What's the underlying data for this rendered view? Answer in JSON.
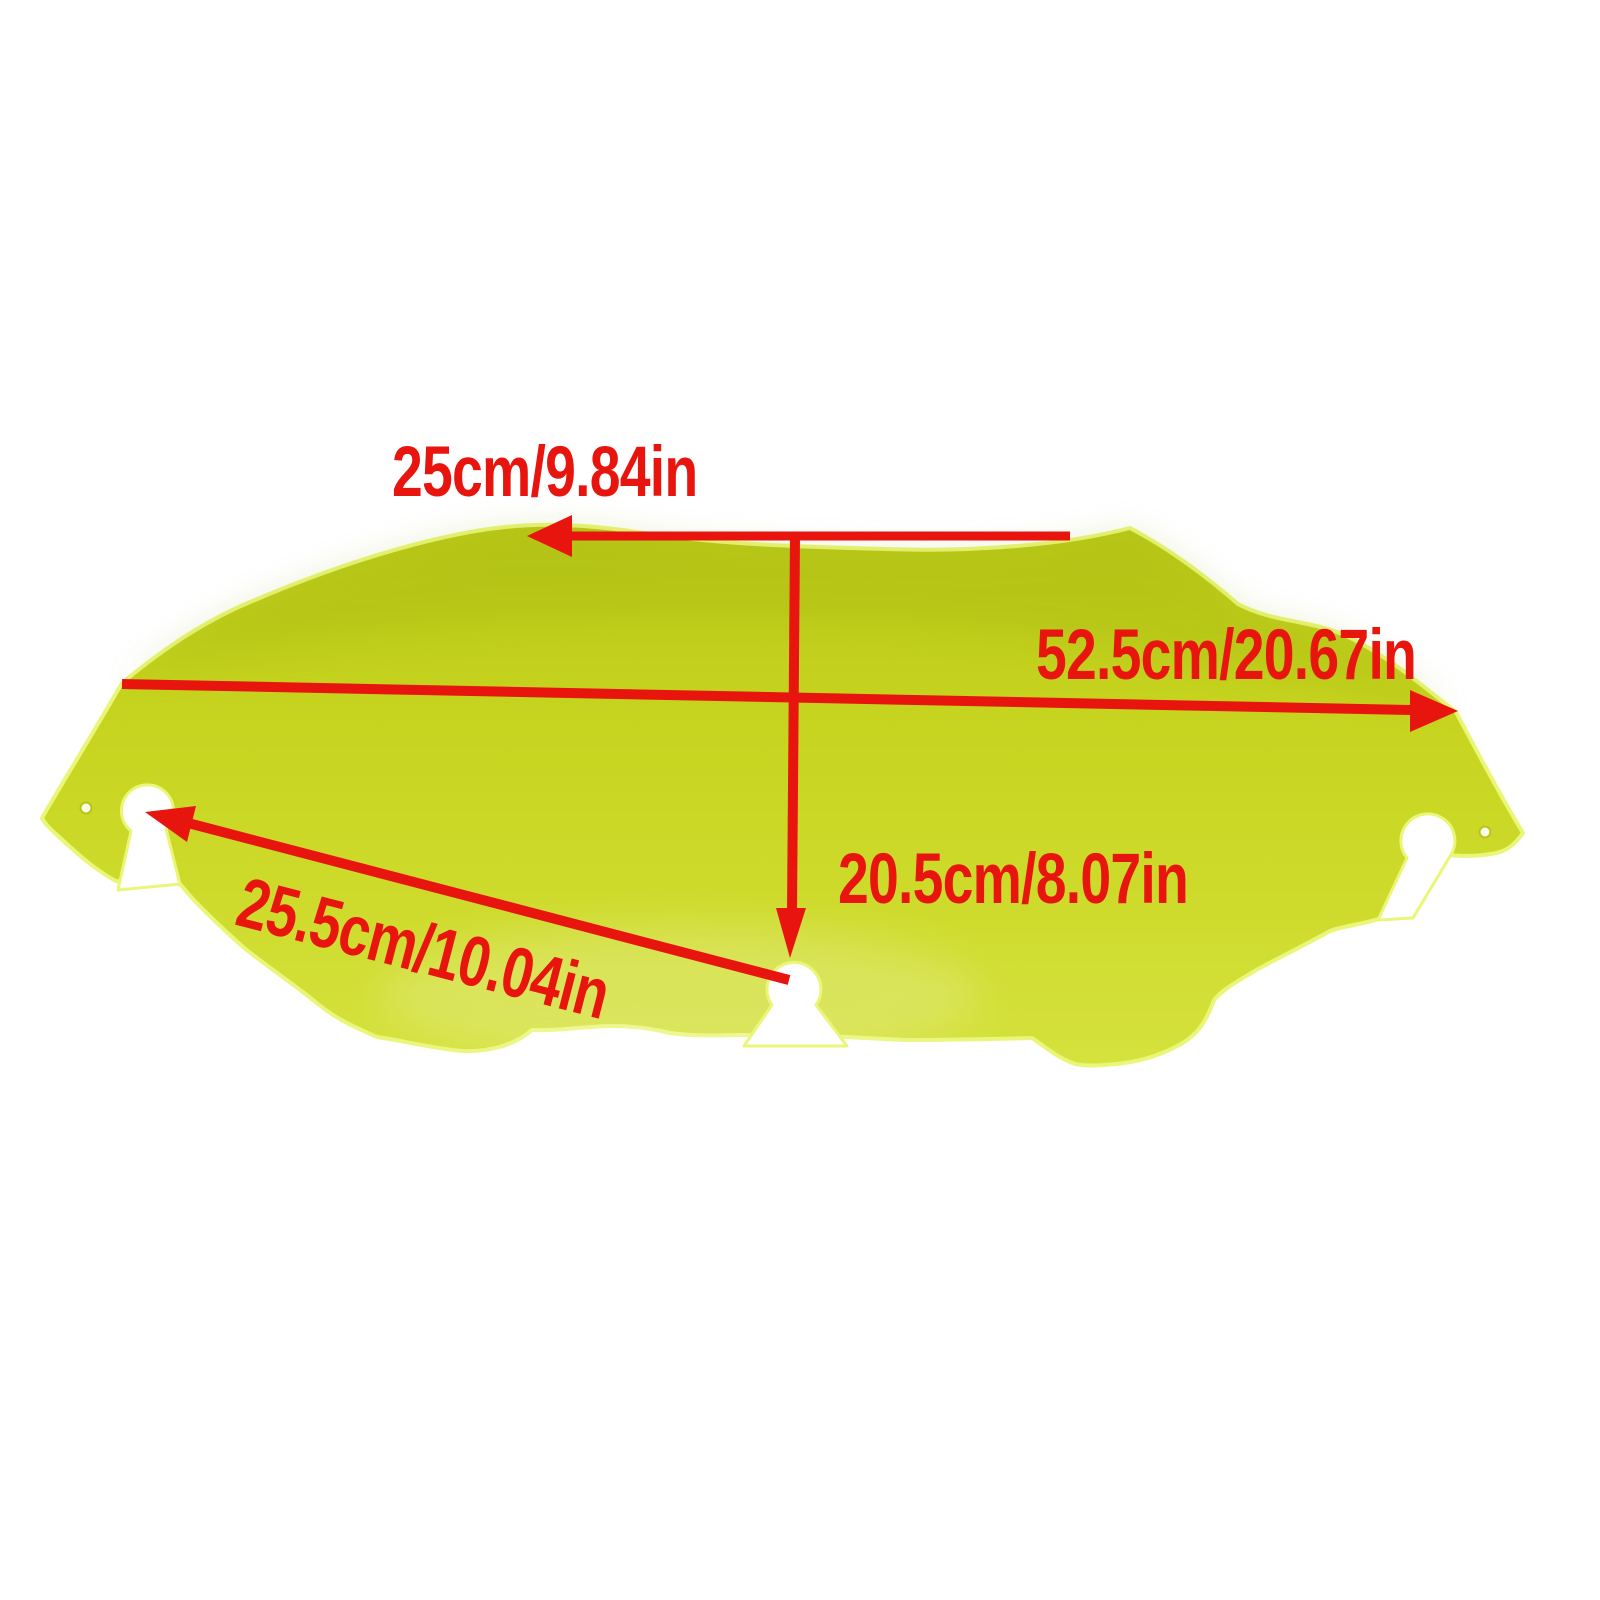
{
  "page": {
    "description": "Product dimension diagram of a fluorescent yellow-green motorcycle windshield on a white background",
    "background": "#ffffff"
  },
  "colors": {
    "annotation": "#e8150f",
    "windshield_fill": "#c8d521",
    "windshield_fill_dark": "#b9c818",
    "windshield_fill_light": "#d6e23e",
    "edge_highlight": "#e9f677"
  },
  "annotations": {
    "upper_width": "25cm/9.84in",
    "overall_width": "52.5cm/20.67in",
    "center_height": "20.5cm/8.07in",
    "hole_spacing": "25.5cm/10.04in"
  }
}
